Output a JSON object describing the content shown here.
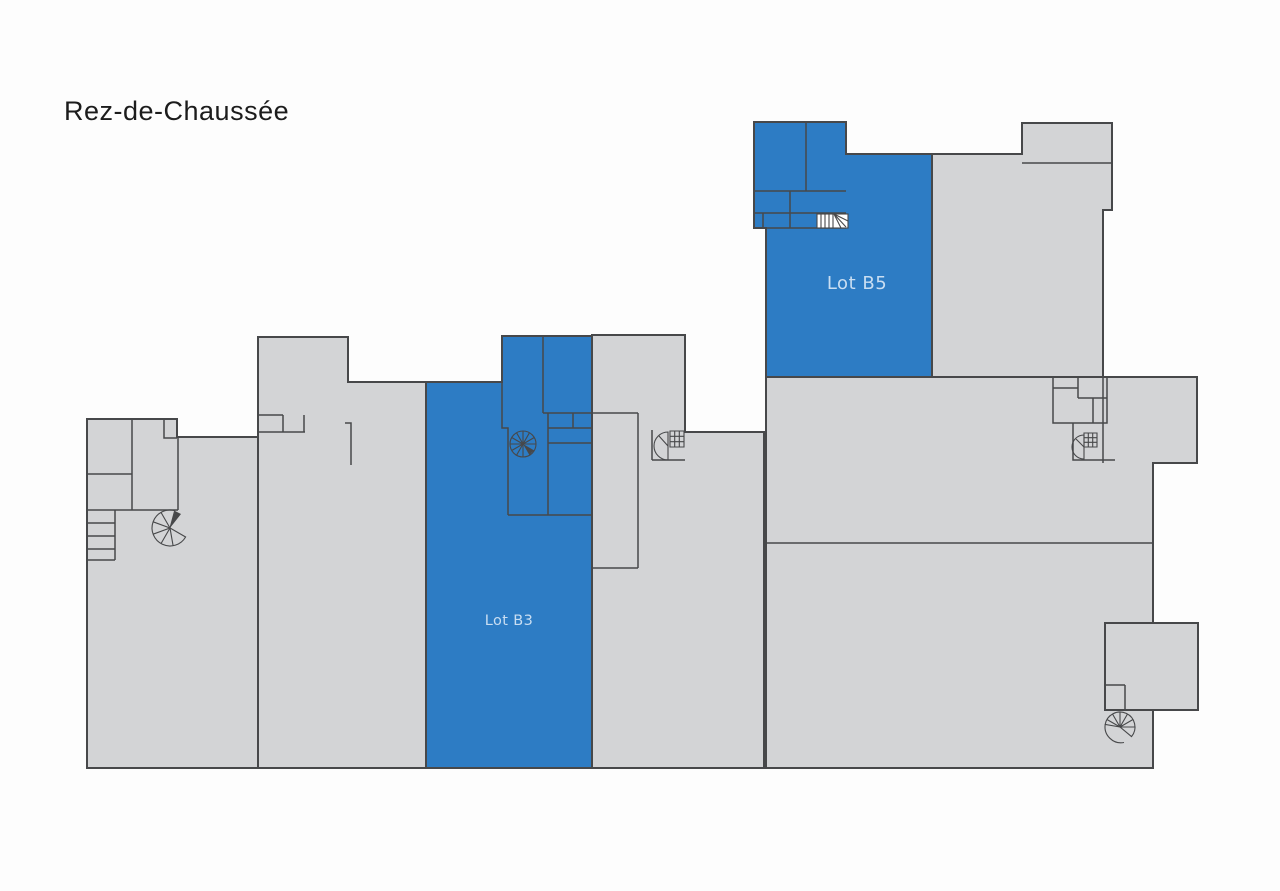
{
  "page": {
    "title": "Rez-de-Chaussée"
  },
  "floor_plan": {
    "lots": {
      "b3": {
        "label": "Lot B3"
      },
      "b5": {
        "label": "Lot B5"
      }
    },
    "colors": {
      "lot_fill": "#2d7cc4",
      "lot_label": "#c9def2",
      "building_fill": "#d3d4d6",
      "wall": "#47484a",
      "background": "#fdfdfd",
      "title_color": "#1c1c1c"
    },
    "icons": {
      "spiral_stairs": [
        "left-wing",
        "lot-b3",
        "center-block",
        "right-wing-top",
        "right-wing-bottom"
      ],
      "straight_stairs": [
        "left-wing-steps",
        "lot-b5-landing"
      ]
    }
  }
}
